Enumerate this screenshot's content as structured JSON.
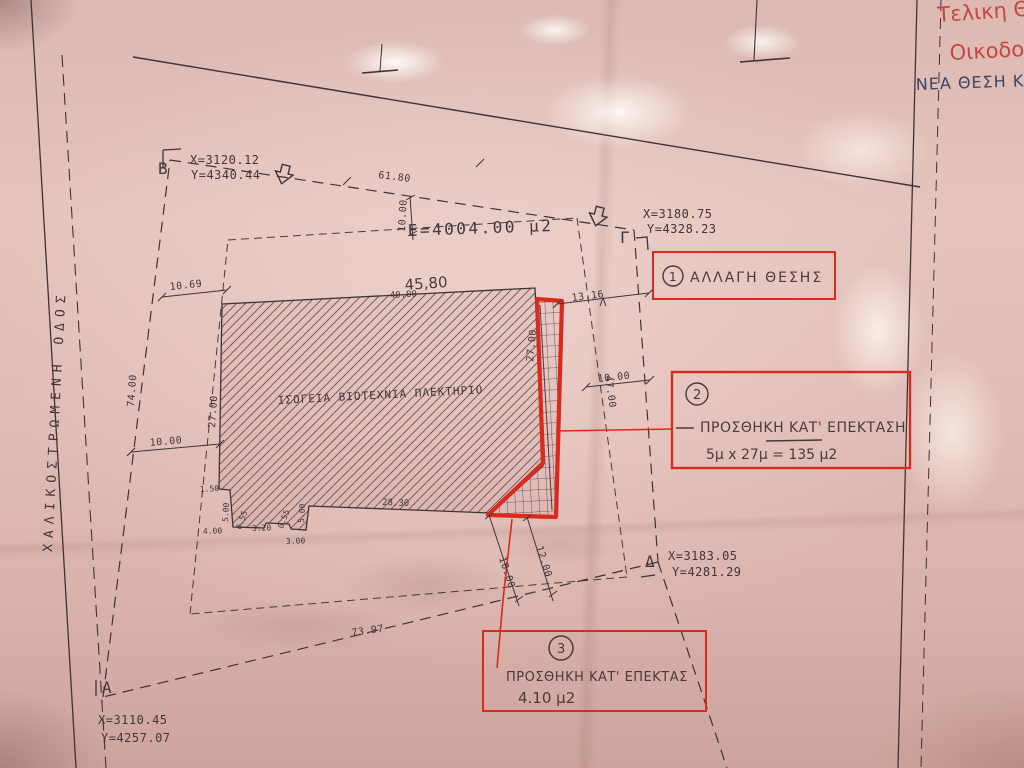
{
  "drawing": {
    "type": "topographic-site-plan-photo",
    "labels": {
      "area": "E=4004.00 μ2",
      "building": "ΙΣΟΓΕΙΑ ΒΙΟΤΕΧΝΙΑ ΠΛΕΚΤΗΡΙΟ",
      "road": "ΧΑΛΙΚΟΣΤΡΩΜΕΝΗ ΟΔΟΣ"
    },
    "points": {
      "a": {
        "label": "A",
        "x": "X=3110.45",
        "y": "Y=4257.07"
      },
      "b": {
        "label": "B",
        "x": "X=3120.12",
        "y": "Y=4340.44"
      },
      "g": {
        "label": "Γ",
        "x": "X=3180.75",
        "y": "Y=4328.23"
      },
      "d": {
        "label": "Δ",
        "x": "X=3183.05",
        "y": "Y=4281.29"
      }
    },
    "dims": {
      "d61_80": "61.80",
      "d10_00_top": "10.00",
      "d45_80": "45,80",
      "d40_00": "40.00",
      "d13_16": "13.16",
      "d10_69": "10.69",
      "d74_00": "74.00",
      "d10_00_left": "10.00",
      "d27_00_left": "27.00",
      "d27_00_strip": "27.00",
      "d10_00_right": "10.00",
      "d47_00": "47.00",
      "d28_30": "28.30",
      "d1_50": "1.50",
      "d5_00_a": "5.00",
      "d4_00": "4.00",
      "d0_55_a": "0.55",
      "d3_20": "3.20",
      "d0_55_b": "0.55",
      "d3_00": "3.00",
      "d5_00_b": "5.00",
      "d12_00": "12.00",
      "d10_00_diag": "10.00",
      "d73_97": "73.97"
    },
    "annotations": {
      "change": {
        "num": "1",
        "text": "ΑΛΛΑΓΗ ΘΕΣΗΣ"
      },
      "extension_side": {
        "num": "2",
        "title": "ΠΡΟΣΘΗΚΗ ΚΑΤ' ΕΠΕΚΤΑΣΗ",
        "calc": "5μ x 27μ = 135 μ2"
      },
      "extension_bottom": {
        "num": "3",
        "title": "ΠΡΟΣΘΗΚΗ ΚΑΤ' ΕΠΕΚΤΑΣ",
        "calc": "4.10 μ2"
      }
    },
    "handwriting": {
      "red1": "Τελικη Θ",
      "red2": "Οικοδομ",
      "blue1": "ΝΕΑ ΘΕΣΗ Κ"
    },
    "colors": {
      "annotation_red": "#d92a1e",
      "handwriting_red": "#c8463c",
      "handwriting_blue": "#3b4466",
      "ink": "#42353b",
      "paper": "#ddbab4"
    }
  }
}
